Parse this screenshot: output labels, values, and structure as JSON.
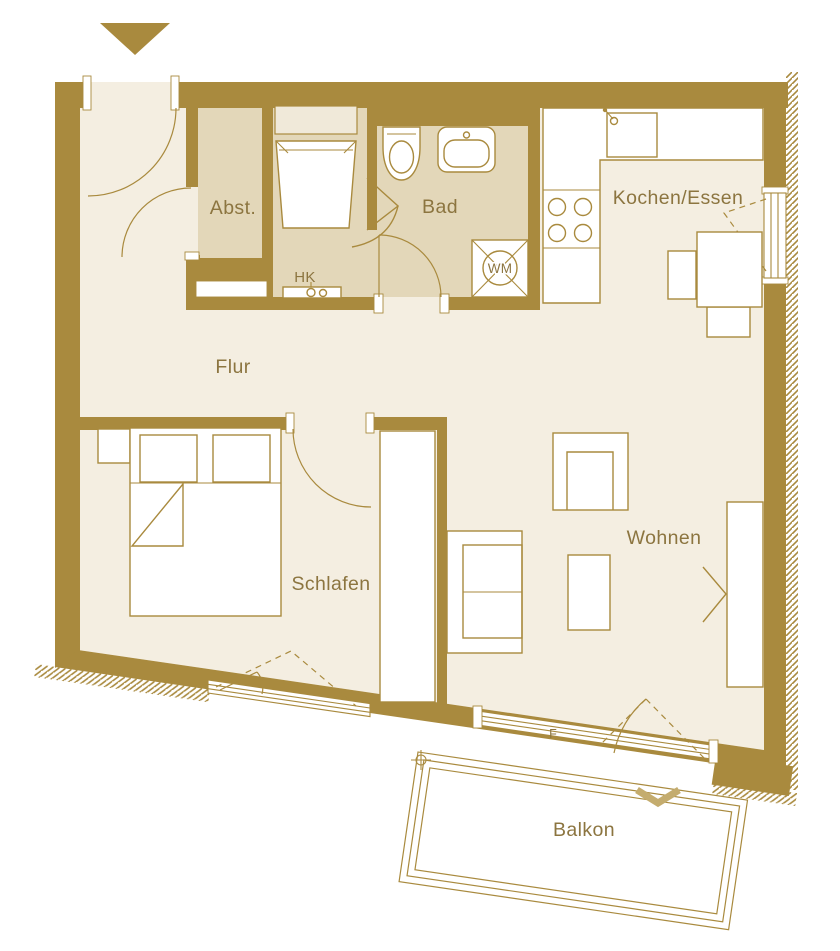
{
  "floorplan": {
    "rooms": {
      "abst": "Abst.",
      "bad": "Bad",
      "kochen_essen": "Kochen/Essen",
      "flur": "Flur",
      "schlafen": "Schlafen",
      "wohnen": "Wohnen",
      "balkon": "Balkon"
    },
    "annotations": {
      "radiator": "HK",
      "washing_machine": "WM",
      "fixed_glazing": "F"
    },
    "colors": {
      "wall": "#A98A3E",
      "floor_light": "#F4EEE1",
      "floor_wet": "#E3D7B9",
      "furniture_fill": "#FFFFFF",
      "label_text": "#8C7540",
      "balcony_chevron": "#C4AC6E",
      "background": "#FFFFFF"
    }
  }
}
